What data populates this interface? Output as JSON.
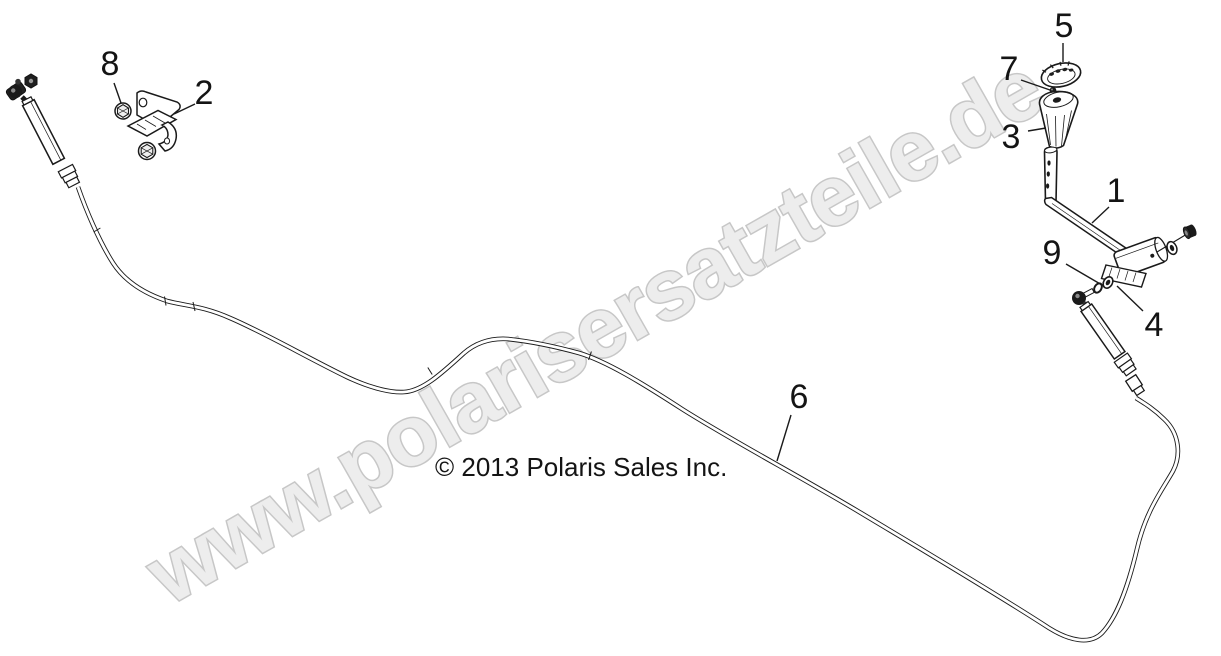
{
  "image": {
    "width": 1221,
    "height": 656,
    "background": "#ffffff"
  },
  "colors": {
    "line": "#1a1a1a",
    "watermark_fill": "#ededed",
    "watermark_outline": "#c7c7c7",
    "callout_text": "#141414"
  },
  "watermark": {
    "text": "www.polarisersatzteile.de"
  },
  "copyright": {
    "text": "© 2013 Polaris Sales Inc."
  },
  "callouts": [
    {
      "label": "1",
      "x": 1116,
      "y": 202,
      "leader": [
        1109,
        207,
        1092,
        223
      ]
    },
    {
      "label": "2",
      "x": 204,
      "y": 104,
      "leader": [
        195,
        104,
        174,
        114
      ]
    },
    {
      "label": "3",
      "x": 1011,
      "y": 148,
      "leader": [
        1028,
        131,
        1046,
        128
      ]
    },
    {
      "label": "4",
      "x": 1154,
      "y": 336,
      "leader": [
        1143,
        311,
        1117,
        286
      ]
    },
    {
      "label": "5",
      "x": 1064,
      "y": 37,
      "leader": [
        1063,
        43,
        1063,
        62
      ]
    },
    {
      "label": "6",
      "x": 799,
      "y": 408,
      "leader": [
        791,
        415,
        777,
        461
      ]
    },
    {
      "label": "7",
      "x": 1009,
      "y": 80,
      "leader": [
        1021,
        80,
        1050,
        90
      ]
    },
    {
      "label": "8",
      "x": 110,
      "y": 75,
      "leader": [
        114,
        83,
        121,
        103
      ]
    },
    {
      "label": "9",
      "x": 1052,
      "y": 264,
      "leader": [
        1066,
        264,
        1102,
        285
      ]
    }
  ]
}
